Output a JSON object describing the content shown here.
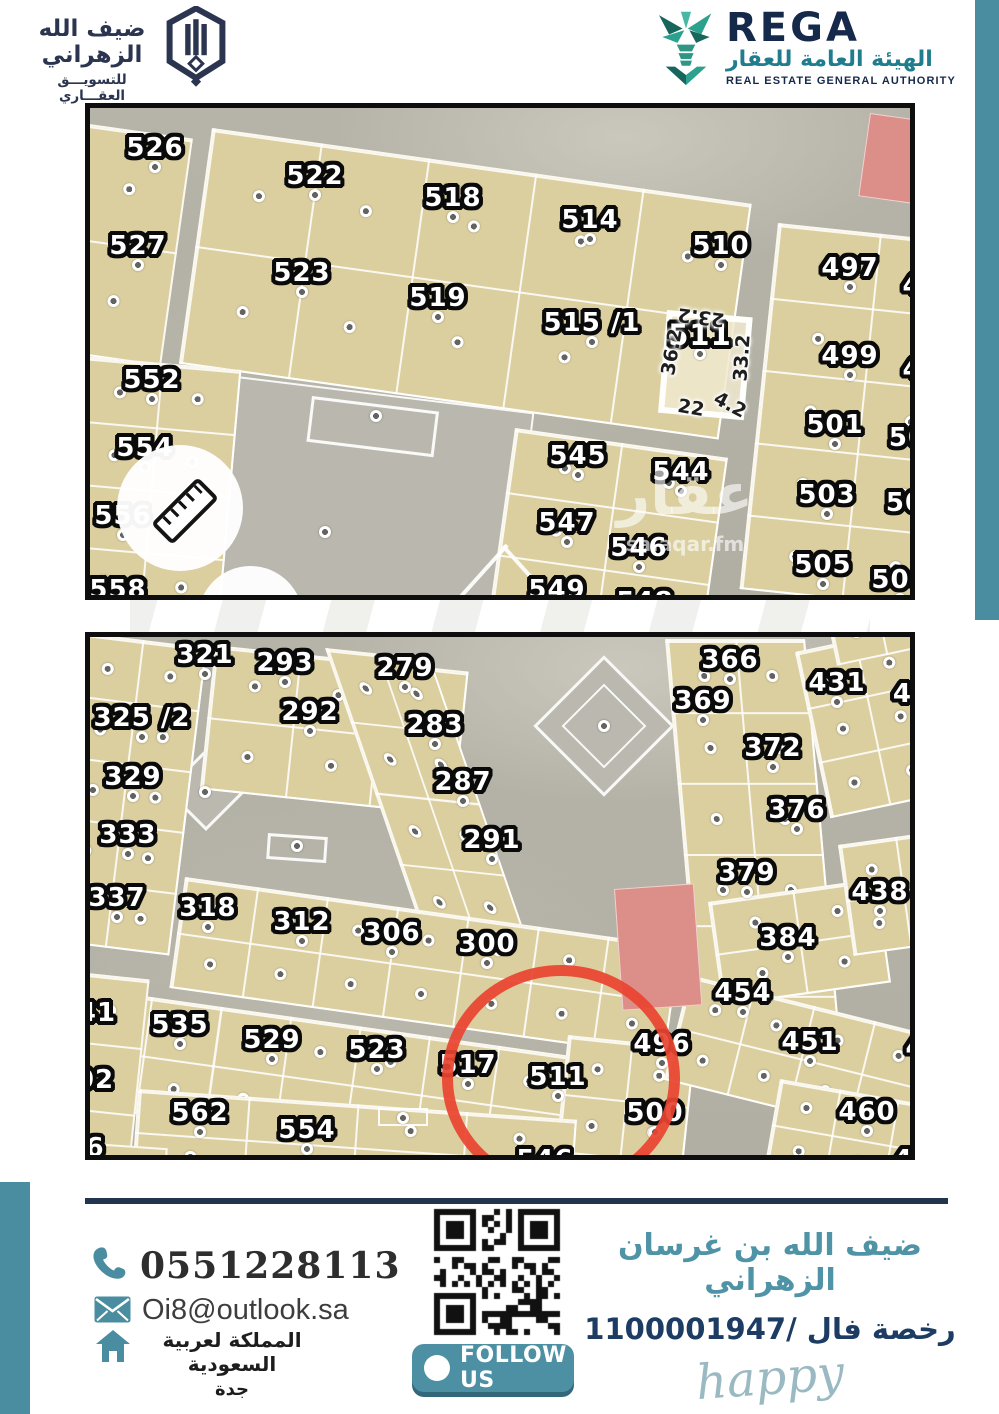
{
  "header": {
    "company_logo": {
      "title_ar": "ضيف الله الزهراني",
      "subtitle_ar": "للتسويـــق العقـــاري"
    },
    "rega": {
      "name": "REGA",
      "name_ar": "الهيئة العامة للعقار",
      "name_en": "REAL ESTATE GENERAL AUTHORITY"
    }
  },
  "colors": {
    "teal": "#4a8da1",
    "navy": "#22344e",
    "plot_beige": "#dbcfa0",
    "road_gray": "#b4b2a6",
    "red_plot": "#dc8e88",
    "circle_red": "#ea4430"
  },
  "map1": {
    "block_color": "#dbcfa0",
    "watermark": {
      "word": "عقار",
      "site": "sa.aqar.fm"
    },
    "blocks": [
      {
        "x": -8,
        "y": 15,
        "w": 112,
        "h": 230,
        "rot": 8,
        "cols": 1,
        "rows": 2
      },
      {
        "x": 122,
        "y": 20,
        "w": 545,
        "h": 238,
        "rot": 8,
        "cols": 5,
        "rows": 2
      },
      {
        "x": 688,
        "y": 115,
        "w": 205,
        "h": 368,
        "rot": 6,
        "cols": 2,
        "rows": 5
      },
      {
        "x": -8,
        "y": 248,
        "w": 160,
        "h": 255,
        "rot": 5,
        "cols": 2,
        "rows": 4
      },
      {
        "x": 425,
        "y": 320,
        "w": 215,
        "h": 192,
        "rot": 8,
        "cols": 2,
        "rows": 3
      }
    ],
    "plots": [
      {
        "label": "526",
        "x": 65,
        "y": 40
      },
      {
        "label": "522",
        "x": 225,
        "y": 68
      },
      {
        "label": "518",
        "x": 363,
        "y": 90
      },
      {
        "label": "514",
        "x": 500,
        "y": 112
      },
      {
        "label": "510",
        "x": 631,
        "y": 138
      },
      {
        "label": "497",
        "x": 760,
        "y": 160
      },
      {
        "label": "527",
        "x": 48,
        "y": 138
      },
      {
        "label": "523",
        "x": 212,
        "y": 165
      },
      {
        "label": "519",
        "x": 348,
        "y": 190
      },
      {
        "label": "515 /1",
        "x": 502,
        "y": 215
      },
      {
        "label": "511",
        "x": 610,
        "y": 227,
        "size": 29
      },
      {
        "label": "499",
        "x": 760,
        "y": 248
      },
      {
        "label": "552",
        "x": 62,
        "y": 272
      },
      {
        "label": "554",
        "x": 55,
        "y": 340
      },
      {
        "label": "556",
        "x": 33,
        "y": 408
      },
      {
        "label": "558",
        "x": 28,
        "y": 482
      },
      {
        "label": "545",
        "x": 488,
        "y": 348
      },
      {
        "label": "544",
        "x": 591,
        "y": 364
      },
      {
        "label": "547",
        "x": 477,
        "y": 415
      },
      {
        "label": "546",
        "x": 549,
        "y": 440
      },
      {
        "label": "549",
        "x": 467,
        "y": 482
      },
      {
        "label": "548",
        "x": 555,
        "y": 494
      },
      {
        "label": "501",
        "x": 745,
        "y": 317
      },
      {
        "label": "503",
        "x": 737,
        "y": 387
      },
      {
        "label": "505",
        "x": 733,
        "y": 457
      },
      {
        "label": "504",
        "x": 810,
        "y": 472
      },
      {
        "label": "4",
        "x": 822,
        "y": 178,
        "dot": false
      },
      {
        "label": "4",
        "x": 822,
        "y": 262,
        "dot": false
      },
      {
        "label": "50",
        "x": 818,
        "y": 330,
        "dot": false
      },
      {
        "label": "50",
        "x": 815,
        "y": 395,
        "dot": false
      }
    ],
    "dims": [
      {
        "t": "23.2",
        "x": 611,
        "y": 209,
        "r": 187
      },
      {
        "t": "36.2",
        "x": 582,
        "y": 244,
        "r": -80
      },
      {
        "t": "33.2",
        "x": 652,
        "y": 250,
        "r": -86
      },
      {
        "t": "22",
        "x": 601,
        "y": 300,
        "r": 10
      },
      {
        "t": "4.2",
        "x": 640,
        "y": 297,
        "r": 28
      }
    ],
    "xdots": [
      [
        286,
        308
      ],
      [
        235,
        424
      ]
    ]
  },
  "map2": {
    "block_color": "#dbcfa0",
    "blocks": [
      {
        "x": -12,
        "y": -5,
        "w": 130,
        "h": 310,
        "rot": 7,
        "cols": 2,
        "rows": 5
      },
      {
        "x": 125,
        "y": 8,
        "w": 255,
        "h": 145,
        "rot": 6,
        "cols": 3,
        "rows": 2
      },
      {
        "x": 235,
        "y": 11,
        "w": 106,
        "h": 345,
        "rot": 6,
        "skew": 25,
        "cols": 2,
        "rows": 5
      },
      {
        "x": 575,
        "y": 2,
        "w": 140,
        "h": 430,
        "rot": 0,
        "skew": 5,
        "cols": 2,
        "rows": 6
      },
      {
        "x": 705,
        "y": 15,
        "w": 180,
        "h": 170,
        "rot": -12,
        "cols": 3,
        "rows": 3
      },
      {
        "x": 735,
        "y": -28,
        "w": 150,
        "h": 58,
        "rot": -12,
        "cols": 3,
        "rows": 1
      },
      {
        "x": 95,
        "y": 240,
        "w": 500,
        "h": 112,
        "rot": 8,
        "cols": 7,
        "rows": 2
      },
      {
        "x": -10,
        "y": 350,
        "w": 565,
        "h": 118,
        "rot": 8,
        "cols": 8,
        "rows": 2
      },
      {
        "x": 478,
        "y": 398,
        "w": 128,
        "h": 175,
        "rot": 6,
        "cols": 2,
        "rows": 3
      },
      {
        "x": 618,
        "y": 265,
        "w": 170,
        "h": 105,
        "rot": -8,
        "cols": 2,
        "rows": 2
      },
      {
        "x": 748,
        "y": 208,
        "w": 115,
        "h": 112,
        "rot": -8,
        "cols": 2,
        "rows": 2
      },
      {
        "x": 600,
        "y": 338,
        "w": 255,
        "h": 108,
        "rot": 14,
        "cols": 4,
        "rows": 2
      },
      {
        "x": 690,
        "y": 442,
        "w": 180,
        "h": 92,
        "rot": 10,
        "cols": 3,
        "rows": 2
      },
      {
        "x": 48,
        "y": 452,
        "w": 440,
        "h": 86,
        "rot": 4,
        "cols": 4,
        "rows": 2
      },
      {
        "x": -12,
        "y": 335,
        "w": 72,
        "h": 205,
        "rot": 6,
        "cols": 1,
        "rows": 3
      },
      {
        "x": -12,
        "y": 505,
        "w": 90,
        "h": 40,
        "rot": 4,
        "cols": 1,
        "rows": 1
      }
    ],
    "plots": [
      {
        "label": "321",
        "x": 115,
        "y": 18
      },
      {
        "label": "293",
        "x": 195,
        "y": 26
      },
      {
        "label": "279",
        "x": 315,
        "y": 31
      },
      {
        "label": "366",
        "x": 640,
        "y": 23
      },
      {
        "label": "325 /2",
        "x": 52,
        "y": 81
      },
      {
        "label": "292",
        "x": 220,
        "y": 75
      },
      {
        "label": "283",
        "x": 345,
        "y": 88
      },
      {
        "label": "369",
        "x": 613,
        "y": 64
      },
      {
        "label": "431",
        "x": 747,
        "y": 46
      },
      {
        "label": "43",
        "x": 822,
        "y": 57,
        "dot": false
      },
      {
        "label": "329",
        "x": 43,
        "y": 140
      },
      {
        "label": "287",
        "x": 373,
        "y": 145
      },
      {
        "label": "372",
        "x": 683,
        "y": 111
      },
      {
        "label": "333",
        "x": 38,
        "y": 198
      },
      {
        "label": "291",
        "x": 402,
        "y": 203
      },
      {
        "label": "376",
        "x": 707,
        "y": 173
      },
      {
        "label": "337",
        "x": 27,
        "y": 261
      },
      {
        "label": "318",
        "x": 118,
        "y": 271
      },
      {
        "label": "312",
        "x": 212,
        "y": 285
      },
      {
        "label": "306",
        "x": 302,
        "y": 296
      },
      {
        "label": "300",
        "x": 397,
        "y": 307
      },
      {
        "label": "379",
        "x": 657,
        "y": 236
      },
      {
        "label": "438",
        "x": 790,
        "y": 255
      },
      {
        "label": "384",
        "x": 698,
        "y": 301
      },
      {
        "label": "454",
        "x": 653,
        "y": 356
      },
      {
        "label": "451",
        "x": 720,
        "y": 405
      },
      {
        "label": "496",
        "x": 572,
        "y": 407
      },
      {
        "label": "41",
        "x": 7,
        "y": 376,
        "dot": false
      },
      {
        "label": "535",
        "x": 90,
        "y": 388
      },
      {
        "label": "529",
        "x": 182,
        "y": 403
      },
      {
        "label": "523",
        "x": 287,
        "y": 413
      },
      {
        "label": "517",
        "x": 378,
        "y": 428
      },
      {
        "label": "511",
        "x": 468,
        "y": 440
      },
      {
        "label": "500",
        "x": 565,
        "y": 476
      },
      {
        "label": "460",
        "x": 777,
        "y": 475
      },
      {
        "label": "02",
        "x": 5,
        "y": 443,
        "dot": false
      },
      {
        "label": "562",
        "x": 110,
        "y": 476
      },
      {
        "label": "554",
        "x": 217,
        "y": 493
      },
      {
        "label": "546",
        "x": 455,
        "y": 523,
        "dot": false
      },
      {
        "label": "6",
        "x": 5,
        "y": 511,
        "dot": false
      },
      {
        "label": "45",
        "x": 823,
        "y": 523,
        "dot": false
      },
      {
        "label": "4",
        "x": 825,
        "y": 411,
        "dot": false
      }
    ],
    "xdots": [
      [
        115,
        155
      ],
      [
        514,
        89
      ],
      [
        313,
        481
      ],
      [
        207,
        209
      ]
    ]
  },
  "footer": {
    "phone": "0551228113",
    "email": "Oi8@outlook.sa",
    "country_ar": "المملكة لعربية السعودية",
    "city_ar": "جدة",
    "follow_us": "FOLLOW US",
    "agent_name_ar": "ضيف الله بن غرسان الزهراني",
    "license_ar": "رخصة فال /1100001947",
    "signature": "happy"
  }
}
